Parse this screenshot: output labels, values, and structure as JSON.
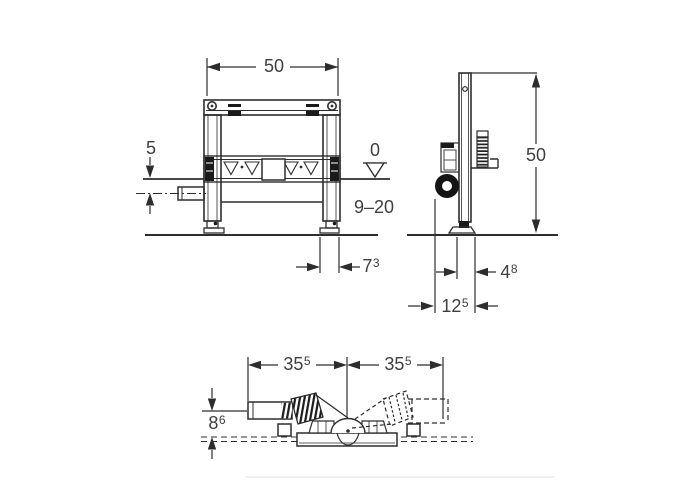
{
  "front": {
    "width": "50",
    "offset": "5",
    "datum": "0",
    "range": "9–20",
    "foot": {
      "main": "7",
      "sup": "3"
    }
  },
  "side": {
    "height": "50",
    "foot": {
      "main": "4",
      "sup": "8"
    },
    "depth": {
      "main": "12",
      "sup": "5"
    }
  },
  "plan": {
    "left": {
      "main": "35",
      "sup": "5"
    },
    "right": {
      "main": "35",
      "sup": "5"
    },
    "offset": {
      "main": "8",
      "sup": "6"
    }
  }
}
